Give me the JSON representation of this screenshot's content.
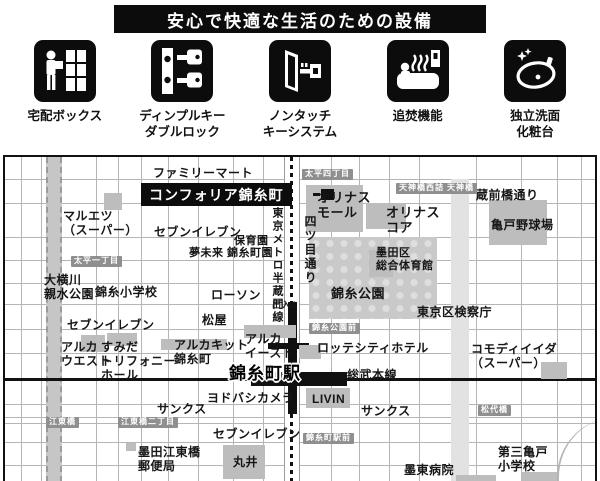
{
  "banner": {
    "title": "安心で快適な生活のための設備"
  },
  "amenities": [
    {
      "icon": "delivery-box-icon",
      "label": "宅配ボックス"
    },
    {
      "icon": "dimple-key-icon",
      "label": "ディンプルキー\nダブルロック"
    },
    {
      "icon": "nontouch-key-icon",
      "label": "ノンタッチ\nキーシステム"
    },
    {
      "icon": "reheating-icon",
      "label": "追焚機能"
    },
    {
      "icon": "washbasin-icon",
      "label": "独立洗面\n化粧台"
    }
  ],
  "map": {
    "property_name": "コンフォリア錦糸町",
    "station_name": "錦糸町駅",
    "labels": [
      {
        "text": "ファミリーマート",
        "x": 148,
        "y": 9,
        "size": 12
      },
      {
        "text": "マルエツ\n（スーパー）",
        "x": 58,
        "y": 52,
        "size": 12
      },
      {
        "text": "セブンイレブン",
        "x": 149,
        "y": 68,
        "size": 12
      },
      {
        "text": "保育園",
        "x": 229,
        "y": 78,
        "size": 11
      },
      {
        "text": "夢未来 錦糸町園",
        "x": 184,
        "y": 90,
        "size": 11
      },
      {
        "text": "オリナス\nモール",
        "x": 312,
        "y": 33,
        "size": 13
      },
      {
        "text": "オリナス\nコア",
        "x": 381,
        "y": 48,
        "size": 13
      },
      {
        "text": "蔵前橋通り",
        "x": 471,
        "y": 31,
        "size": 12
      },
      {
        "text": "亀戸野球場",
        "x": 486,
        "y": 61,
        "size": 12
      },
      {
        "text": "墨田区\n総合体育館",
        "x": 371,
        "y": 90,
        "size": 11
      },
      {
        "text": "錦糸公園",
        "x": 326,
        "y": 129,
        "size": 13
      },
      {
        "text": "東京区検察庁",
        "x": 412,
        "y": 148,
        "size": 12
      },
      {
        "text": "出入4",
        "x": 267,
        "y": 143,
        "size": 9
      },
      {
        "text": "大横川\n親水公園",
        "x": 39,
        "y": 116,
        "size": 12
      },
      {
        "text": "錦糸小学校",
        "x": 90,
        "y": 128,
        "size": 12
      },
      {
        "text": "ローソン",
        "x": 206,
        "y": 131,
        "size": 12
      },
      {
        "text": "セブンイレブン",
        "x": 62,
        "y": 161,
        "size": 12
      },
      {
        "text": "松屋",
        "x": 197,
        "y": 156,
        "size": 12
      },
      {
        "text": "アルカ\nウエスト",
        "x": 56,
        "y": 183,
        "size": 12
      },
      {
        "text": "すみだ\nトリフォニー\nホール",
        "x": 96,
        "y": 183,
        "size": 12
      },
      {
        "text": "アルカキット\n錦糸町",
        "x": 169,
        "y": 181,
        "size": 12
      },
      {
        "text": "アルカ\nイースト",
        "x": 240,
        "y": 175,
        "size": 12
      },
      {
        "text": "ロッテシティホテル",
        "x": 312,
        "y": 184,
        "size": 12
      },
      {
        "text": "コモディイイダ\n（スーパー）",
        "x": 466,
        "y": 185,
        "size": 12
      },
      {
        "text": "総武本線",
        "x": 342,
        "y": 211,
        "size": 12
      },
      {
        "text": "ヨドバシカメラ",
        "x": 202,
        "y": 234,
        "size": 12
      },
      {
        "text": "LIVIN",
        "x": 307,
        "y": 235,
        "size": 12
      },
      {
        "text": "サンクス",
        "x": 152,
        "y": 245,
        "size": 12
      },
      {
        "text": "サンクス",
        "x": 356,
        "y": 247,
        "size": 12
      },
      {
        "text": "セブンイレブン",
        "x": 208,
        "y": 270,
        "size": 12
      },
      {
        "text": "墨田江東橋\n郵便局",
        "x": 133,
        "y": 288,
        "size": 12
      },
      {
        "text": "丸井",
        "x": 228,
        "y": 298,
        "size": 12
      },
      {
        "text": "墨東病院",
        "x": 399,
        "y": 306,
        "size": 12
      },
      {
        "text": "第三亀戸\n小学校",
        "x": 493,
        "y": 288,
        "size": 12
      }
    ],
    "badges": [
      {
        "text": "太平四丁目",
        "x": 297,
        "y": 12
      },
      {
        "text": "天神橋西詰",
        "x": 391,
        "y": 26
      },
      {
        "text": "天神橋",
        "x": 439,
        "y": 26
      },
      {
        "text": "太平一丁目",
        "x": 66,
        "y": 99
      },
      {
        "text": "錦糸公園前",
        "x": 304,
        "y": 166
      },
      {
        "text": "松代橋",
        "x": 473,
        "y": 248
      },
      {
        "text": "江東橋",
        "x": 41,
        "y": 260
      },
      {
        "text": "江東橋二丁目",
        "x": 113,
        "y": 260
      },
      {
        "text": "錦糸町駅前",
        "x": 298,
        "y": 276
      }
    ],
    "vertical_labels": [
      {
        "text": "東京メトロ半蔵門線",
        "x": 264,
        "y": 50,
        "size": 11
      },
      {
        "text": "四ツ目通り",
        "x": 297,
        "y": 58,
        "size": 12
      }
    ],
    "blocks": [
      {
        "x": 99,
        "y": 36,
        "w": 18,
        "h": 17
      },
      {
        "x": 301,
        "y": 28,
        "w": 57,
        "h": 47
      },
      {
        "x": 361,
        "y": 46,
        "w": 40,
        "h": 26
      },
      {
        "x": 484,
        "y": 43,
        "w": 58,
        "h": 45
      },
      {
        "x": 364,
        "y": 93,
        "w": 24,
        "h": 27
      },
      {
        "x": 76,
        "y": 178,
        "w": 24,
        "h": 17
      },
      {
        "x": 102,
        "y": 176,
        "w": 30,
        "h": 13
      },
      {
        "x": 156,
        "y": 182,
        "w": 66,
        "h": 11
      },
      {
        "x": 239,
        "y": 168,
        "w": 52,
        "h": 13
      },
      {
        "x": 294,
        "y": 188,
        "w": 22,
        "h": 14
      },
      {
        "x": 301,
        "y": 231,
        "w": 44,
        "h": 20
      },
      {
        "x": 218,
        "y": 288,
        "w": 42,
        "h": 34
      },
      {
        "x": 536,
        "y": 205,
        "w": 26,
        "h": 17
      },
      {
        "x": 451,
        "y": 318,
        "w": 40,
        "h": 10
      },
      {
        "x": 516,
        "y": 315,
        "w": 36,
        "h": 12
      },
      {
        "x": 121,
        "y": 286,
        "w": 10,
        "h": 8
      }
    ],
    "grid": {
      "h": [
        22,
        46,
        80,
        103,
        126,
        147,
        172,
        196,
        247,
        260,
        266,
        285,
        308
      ],
      "v": [
        16,
        36,
        91,
        113,
        136,
        163,
        193,
        228,
        258,
        326,
        354,
        384,
        414,
        471,
        516,
        552,
        576
      ]
    }
  }
}
